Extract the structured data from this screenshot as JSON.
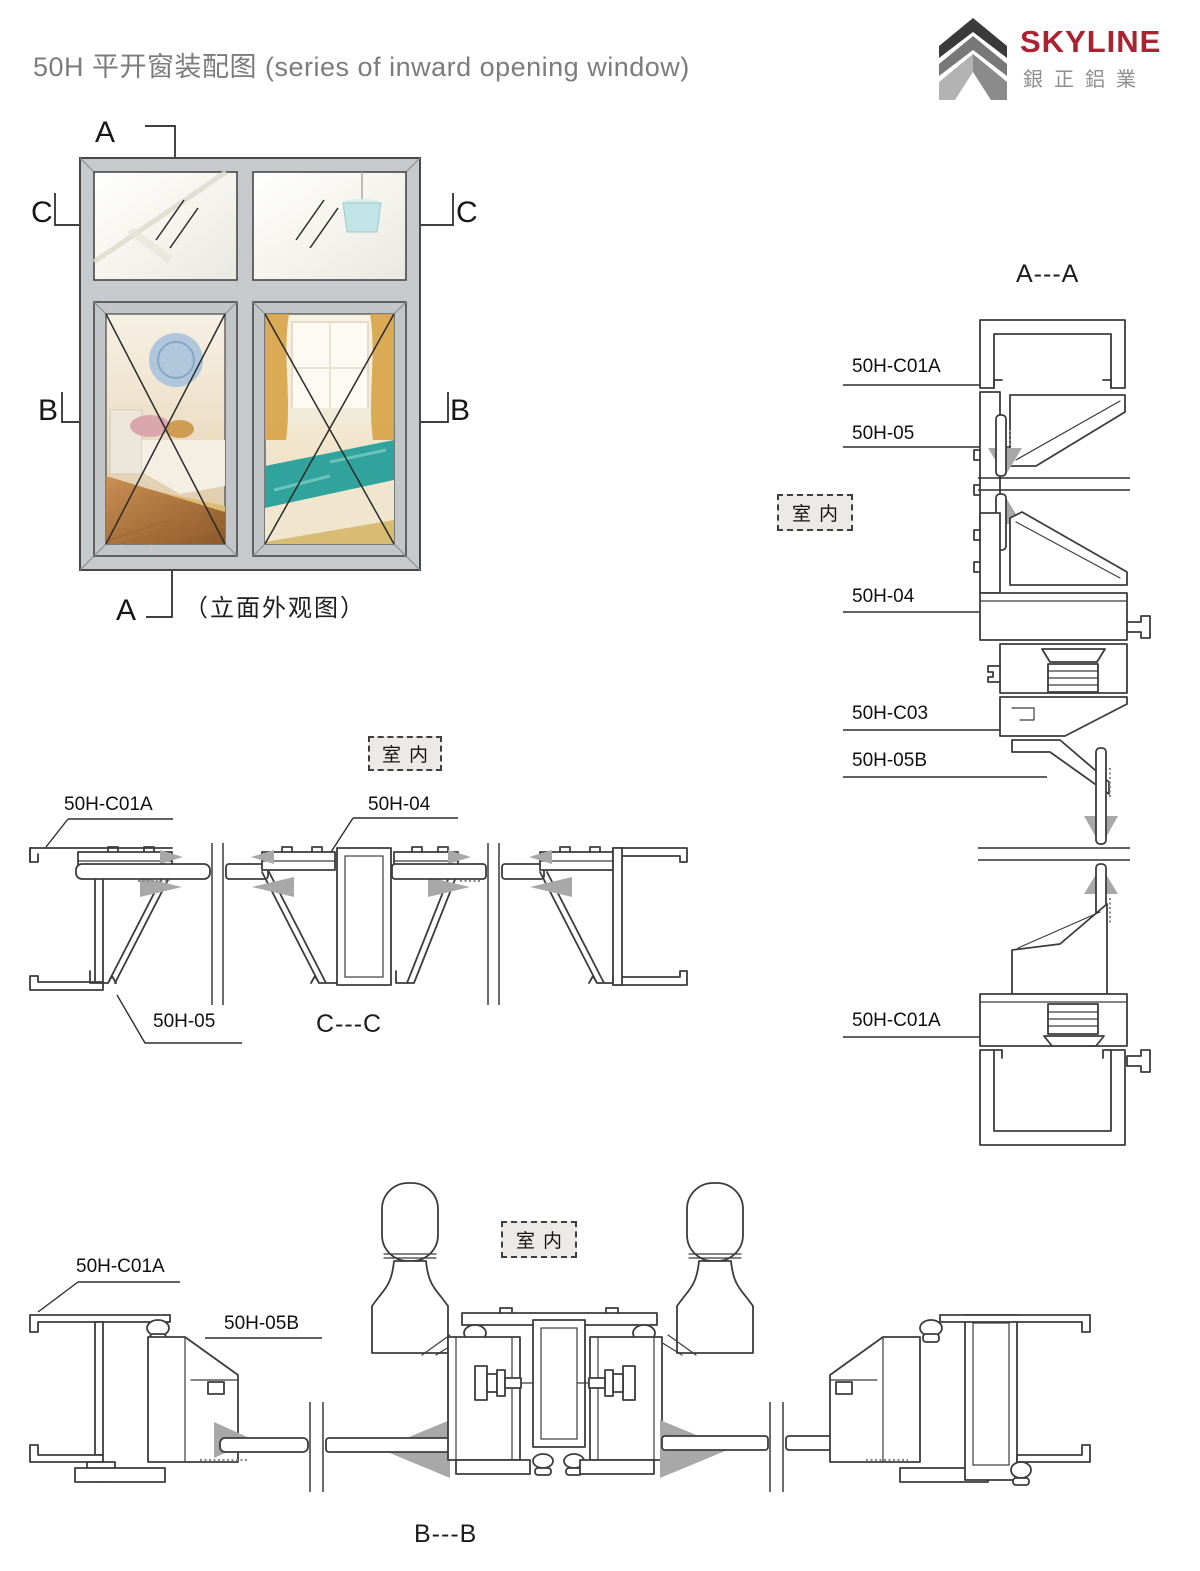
{
  "header": {
    "title": "50H 平开窗装配图 (series of inward opening window)",
    "logo": {
      "brand": "SKYLINE",
      "subtitle": "銀正鋁業"
    }
  },
  "colors": {
    "brand_red": "#ab2230",
    "line": "#3c3c3c",
    "frame_gray": "#c7cacc",
    "gasket_gray": "#a8a8a8",
    "title_gray": "#7c7c7c"
  },
  "elevation": {
    "caption": "（立面外观图）",
    "markers": {
      "a_top": "A",
      "a_bottom": "A",
      "b_left": "B",
      "b_right": "B",
      "c_left": "C",
      "c_right": "C"
    }
  },
  "sections": {
    "aa": {
      "title": "A---A",
      "interior": "室内",
      "labels": {
        "c01a_top": "50H-C01A",
        "b05": "50H-05",
        "b04": "50H-04",
        "c03": "50H-C03",
        "b05b": "50H-05B",
        "c01a_bottom": "50H-C01A"
      }
    },
    "cc": {
      "title": "C---C",
      "interior": "室内",
      "labels": {
        "c01a": "50H-C01A",
        "b04": "50H-04",
        "b05": "50H-05"
      }
    },
    "bb": {
      "title": "B---B",
      "interior": "室内",
      "labels": {
        "c01a": "50H-C01A",
        "b05b": "50H-05B"
      }
    }
  }
}
